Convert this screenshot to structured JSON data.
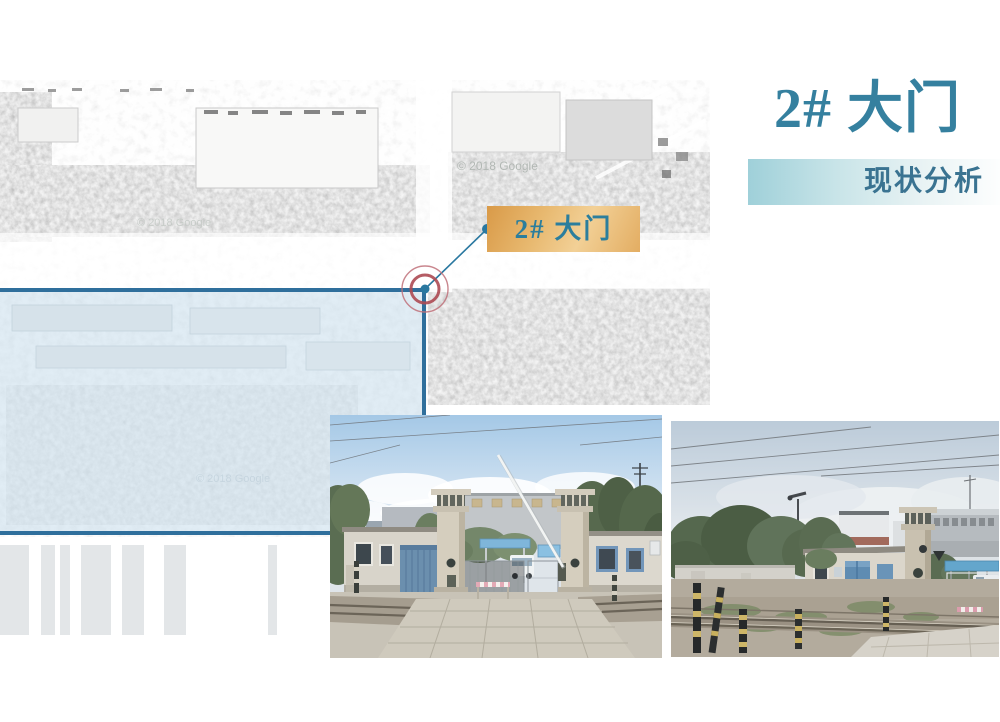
{
  "slide": {
    "title": "2# 大门",
    "subtitle": "现状分析",
    "map_label": "2# 大门",
    "map_watermark": "© 2018 Google",
    "colors": {
      "title_text": "#35809f",
      "subtitle_text": "#3a7391",
      "subtitle_bar_start": "#9fd0d9",
      "label_bg_start": "#d99a48",
      "label_bg_end": "#f2d096",
      "label_text": "#2b7e9d",
      "region_border": "#2f6f9c",
      "region_fill": "rgba(183,212,230,0.42)",
      "marker_red_inner": "#ad4a53",
      "marker_red_outer": "#c0717a",
      "marker_teal": "#2a78a0"
    }
  },
  "photos": {
    "front": {
      "description": "factory gate front view with rail crossing"
    },
    "side": {
      "description": "factory gate side view along railway tracks"
    }
  }
}
